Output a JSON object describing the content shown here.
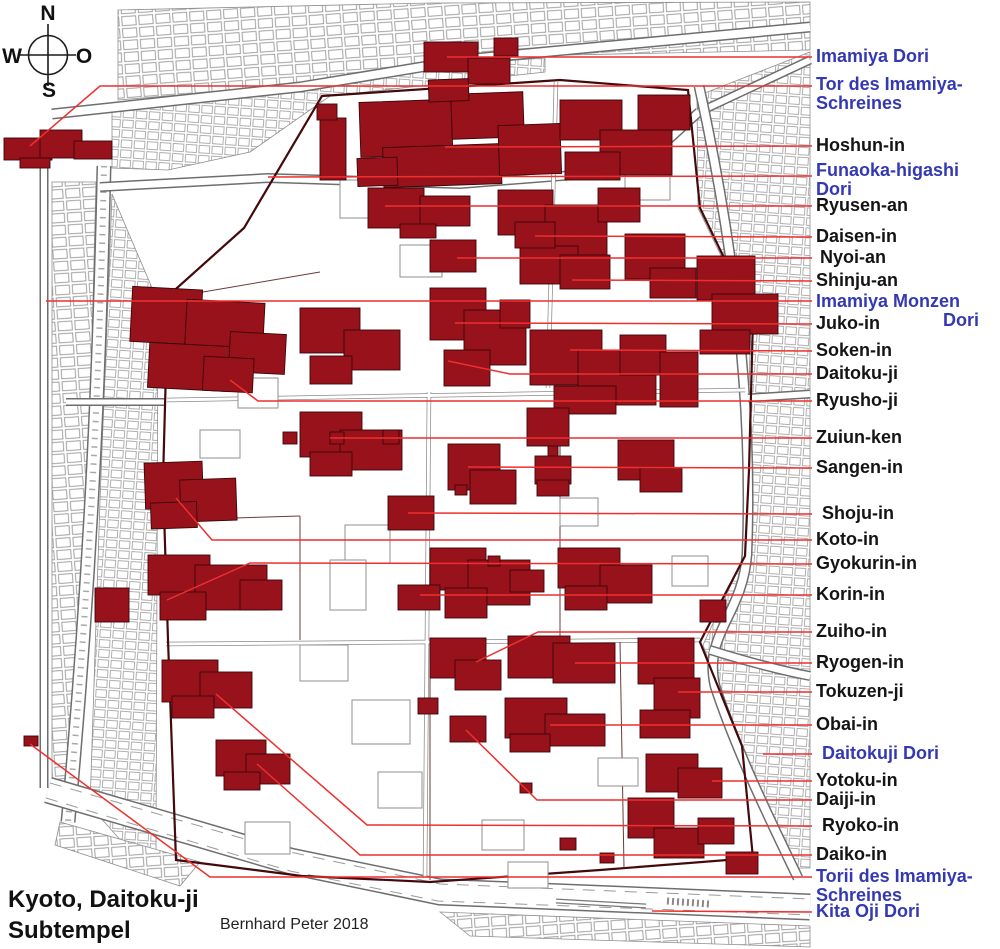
{
  "compass": {
    "n": "N",
    "w": "W",
    "o": "O",
    "s": "S"
  },
  "title": {
    "line1": "Kyoto, Daitoku-ji",
    "line2": "Subtempel"
  },
  "credit": "Bernhard Peter 2018",
  "colors": {
    "temple_red": "#97121b",
    "temple_outline": "#3c060a",
    "leader_red": "#ee2f2f",
    "street_label_blue": "#3439b3",
    "temple_label_black": "#141414",
    "map_line_gray": "#8f8f8f"
  },
  "labels": [
    {
      "id": "imamiya-dori",
      "lines": [
        "Imamiya Dori"
      ],
      "color": "blue",
      "x": 816,
      "y": 57,
      "leader": [
        [
          812,
          57
        ],
        [
          447,
          57
        ]
      ]
    },
    {
      "id": "tor-des-imamiya-schreines",
      "lines": [
        "Tor des Imamiya-",
        "Schreines"
      ],
      "color": "blue",
      "x": 816,
      "y": 85,
      "leader": [
        [
          812,
          86
        ],
        [
          100,
          86
        ],
        [
          30,
          146
        ]
      ]
    },
    {
      "id": "hoshun-in",
      "lines": [
        "Hoshun-in"
      ],
      "color": "black",
      "x": 816,
      "y": 146,
      "leader": [
        [
          812,
          146
        ],
        [
          445,
          147
        ]
      ]
    },
    {
      "id": "funaoka-higashi-dori",
      "lines": [
        "Funaoka-higashi",
        "Dori"
      ],
      "color": "blue",
      "x": 816,
      "y": 171,
      "leader": [
        [
          812,
          176
        ],
        [
          268,
          177
        ]
      ]
    },
    {
      "id": "ryusen-an",
      "lines": [
        "Ryusen-an"
      ],
      "color": "black",
      "x": 816,
      "y": 206,
      "leader": [
        [
          812,
          206
        ],
        [
          385,
          206
        ]
      ]
    },
    {
      "id": "daisen-in",
      "lines": [
        "Daisen-in"
      ],
      "color": "black",
      "x": 816,
      "y": 237,
      "leader": [
        [
          812,
          237
        ],
        [
          535,
          236
        ]
      ]
    },
    {
      "id": "nyoi-an",
      "lines": [
        "Nyoi-an"
      ],
      "color": "black",
      "x": 820,
      "y": 258,
      "leader": [
        [
          812,
          258
        ],
        [
          457,
          258
        ]
      ]
    },
    {
      "id": "shinju-an",
      "lines": [
        "Shinju-an"
      ],
      "color": "black",
      "x": 816,
      "y": 281,
      "leader": [
        [
          812,
          281
        ],
        [
          572,
          280
        ]
      ]
    },
    {
      "id": "imamiya-monzen-dori",
      "lines": [
        "Imamiya Monzen",
        "Dori"
      ],
      "color": "blue",
      "x": 816,
      "y": 302,
      "align2": "right",
      "leader": [
        [
          812,
          301
        ],
        [
          46,
          301
        ]
      ]
    },
    {
      "id": "juko-in",
      "lines": [
        "Juko-in"
      ],
      "color": "black",
      "x": 816,
      "y": 324,
      "leader": [
        [
          812,
          324
        ],
        [
          455,
          323
        ]
      ]
    },
    {
      "id": "soken-in",
      "lines": [
        "Soken-in"
      ],
      "color": "black",
      "x": 816,
      "y": 351,
      "leader": [
        [
          812,
          351
        ],
        [
          570,
          350
        ]
      ]
    },
    {
      "id": "daitoku-ji",
      "lines": [
        "Daitoku-ji"
      ],
      "color": "black",
      "x": 816,
      "y": 374,
      "leader": [
        [
          812,
          374
        ],
        [
          510,
          374
        ],
        [
          448,
          361
        ]
      ]
    },
    {
      "id": "ryusho-ji",
      "lines": [
        "Ryusho-ji"
      ],
      "color": "black",
      "x": 816,
      "y": 401,
      "leader": [
        [
          812,
          401
        ],
        [
          258,
          401
        ],
        [
          230,
          380
        ]
      ]
    },
    {
      "id": "zuiun-ken",
      "lines": [
        "Zuiun-ken"
      ],
      "color": "black",
      "x": 816,
      "y": 438,
      "leader": [
        [
          812,
          438
        ],
        [
          330,
          438
        ]
      ]
    },
    {
      "id": "sangen-in",
      "lines": [
        "Sangen-in"
      ],
      "color": "black",
      "x": 816,
      "y": 468,
      "leader": [
        [
          812,
          468
        ],
        [
          468,
          467
        ]
      ]
    },
    {
      "id": "shoju-in",
      "lines": [
        "Shoju-in"
      ],
      "color": "black",
      "x": 822,
      "y": 514,
      "leader": [
        [
          812,
          514
        ],
        [
          408,
          513
        ]
      ]
    },
    {
      "id": "koto-in",
      "lines": [
        "Koto-in"
      ],
      "color": "black",
      "x": 816,
      "y": 540,
      "leader": [
        [
          812,
          540
        ],
        [
          212,
          540
        ],
        [
          176,
          498
        ]
      ]
    },
    {
      "id": "gyokurin-in",
      "lines": [
        "Gyokurin-in"
      ],
      "color": "black",
      "x": 816,
      "y": 564,
      "leader": [
        [
          812,
          564
        ],
        [
          250,
          563
        ],
        [
          167,
          600
        ]
      ]
    },
    {
      "id": "korin-in",
      "lines": [
        "Korin-in"
      ],
      "color": "black",
      "x": 816,
      "y": 595,
      "leader": [
        [
          812,
          595
        ],
        [
          420,
          595
        ]
      ]
    },
    {
      "id": "zuiho-in",
      "lines": [
        "Zuiho-in"
      ],
      "color": "black",
      "x": 816,
      "y": 632,
      "leader": [
        [
          812,
          632
        ],
        [
          538,
          632
        ],
        [
          476,
          662
        ]
      ]
    },
    {
      "id": "ryogen-in",
      "lines": [
        "Ryogen-in"
      ],
      "color": "black",
      "x": 816,
      "y": 663,
      "leader": [
        [
          812,
          663
        ],
        [
          575,
          663
        ]
      ]
    },
    {
      "id": "tokuzen-ji",
      "lines": [
        "Tokuzen-ji"
      ],
      "color": "black",
      "x": 816,
      "y": 692,
      "leader": [
        [
          812,
          692
        ],
        [
          678,
          692
        ]
      ]
    },
    {
      "id": "obai-in",
      "lines": [
        "Obai-in"
      ],
      "color": "black",
      "x": 816,
      "y": 725,
      "leader": [
        [
          812,
          725
        ],
        [
          550,
          725
        ]
      ]
    },
    {
      "id": "daitokuji-dori",
      "lines": [
        "Daitokuji Dori"
      ],
      "color": "blue",
      "x": 822,
      "y": 754,
      "leader": [
        [
          812,
          754
        ],
        [
          763,
          754
        ]
      ]
    },
    {
      "id": "yotoku-in",
      "lines": [
        "Yotoku-in"
      ],
      "color": "black",
      "x": 816,
      "y": 781,
      "leader": [
        [
          812,
          781
        ],
        [
          712,
          781
        ]
      ]
    },
    {
      "id": "daiji-in",
      "lines": [
        "Daiji-in"
      ],
      "color": "black",
      "x": 816,
      "y": 800,
      "leader": [
        [
          812,
          800
        ],
        [
          537,
          800
        ],
        [
          466,
          730
        ]
      ]
    },
    {
      "id": "ryoko-in",
      "lines": [
        "Ryoko-in"
      ],
      "color": "black",
      "x": 822,
      "y": 826,
      "leader": [
        [
          812,
          826
        ],
        [
          367,
          825
        ],
        [
          216,
          694
        ]
      ]
    },
    {
      "id": "daiko-in",
      "lines": [
        "Daiko-in"
      ],
      "color": "black",
      "x": 816,
      "y": 855,
      "leader": [
        [
          812,
          855
        ],
        [
          360,
          855
        ],
        [
          257,
          764
        ]
      ]
    },
    {
      "id": "torii-des-imamiya-schreines",
      "lines": [
        "Torii des Imamiya-",
        "Schreines"
      ],
      "color": "blue",
      "x": 816,
      "y": 877,
      "leader": [
        [
          812,
          877
        ],
        [
          210,
          877
        ],
        [
          30,
          744
        ]
      ]
    },
    {
      "id": "kita-oji-dori",
      "lines": [
        "Kita Oji Dori"
      ],
      "color": "blue",
      "x": 816,
      "y": 912,
      "leader": [
        [
          812,
          912
        ],
        [
          652,
          911
        ]
      ]
    }
  ]
}
